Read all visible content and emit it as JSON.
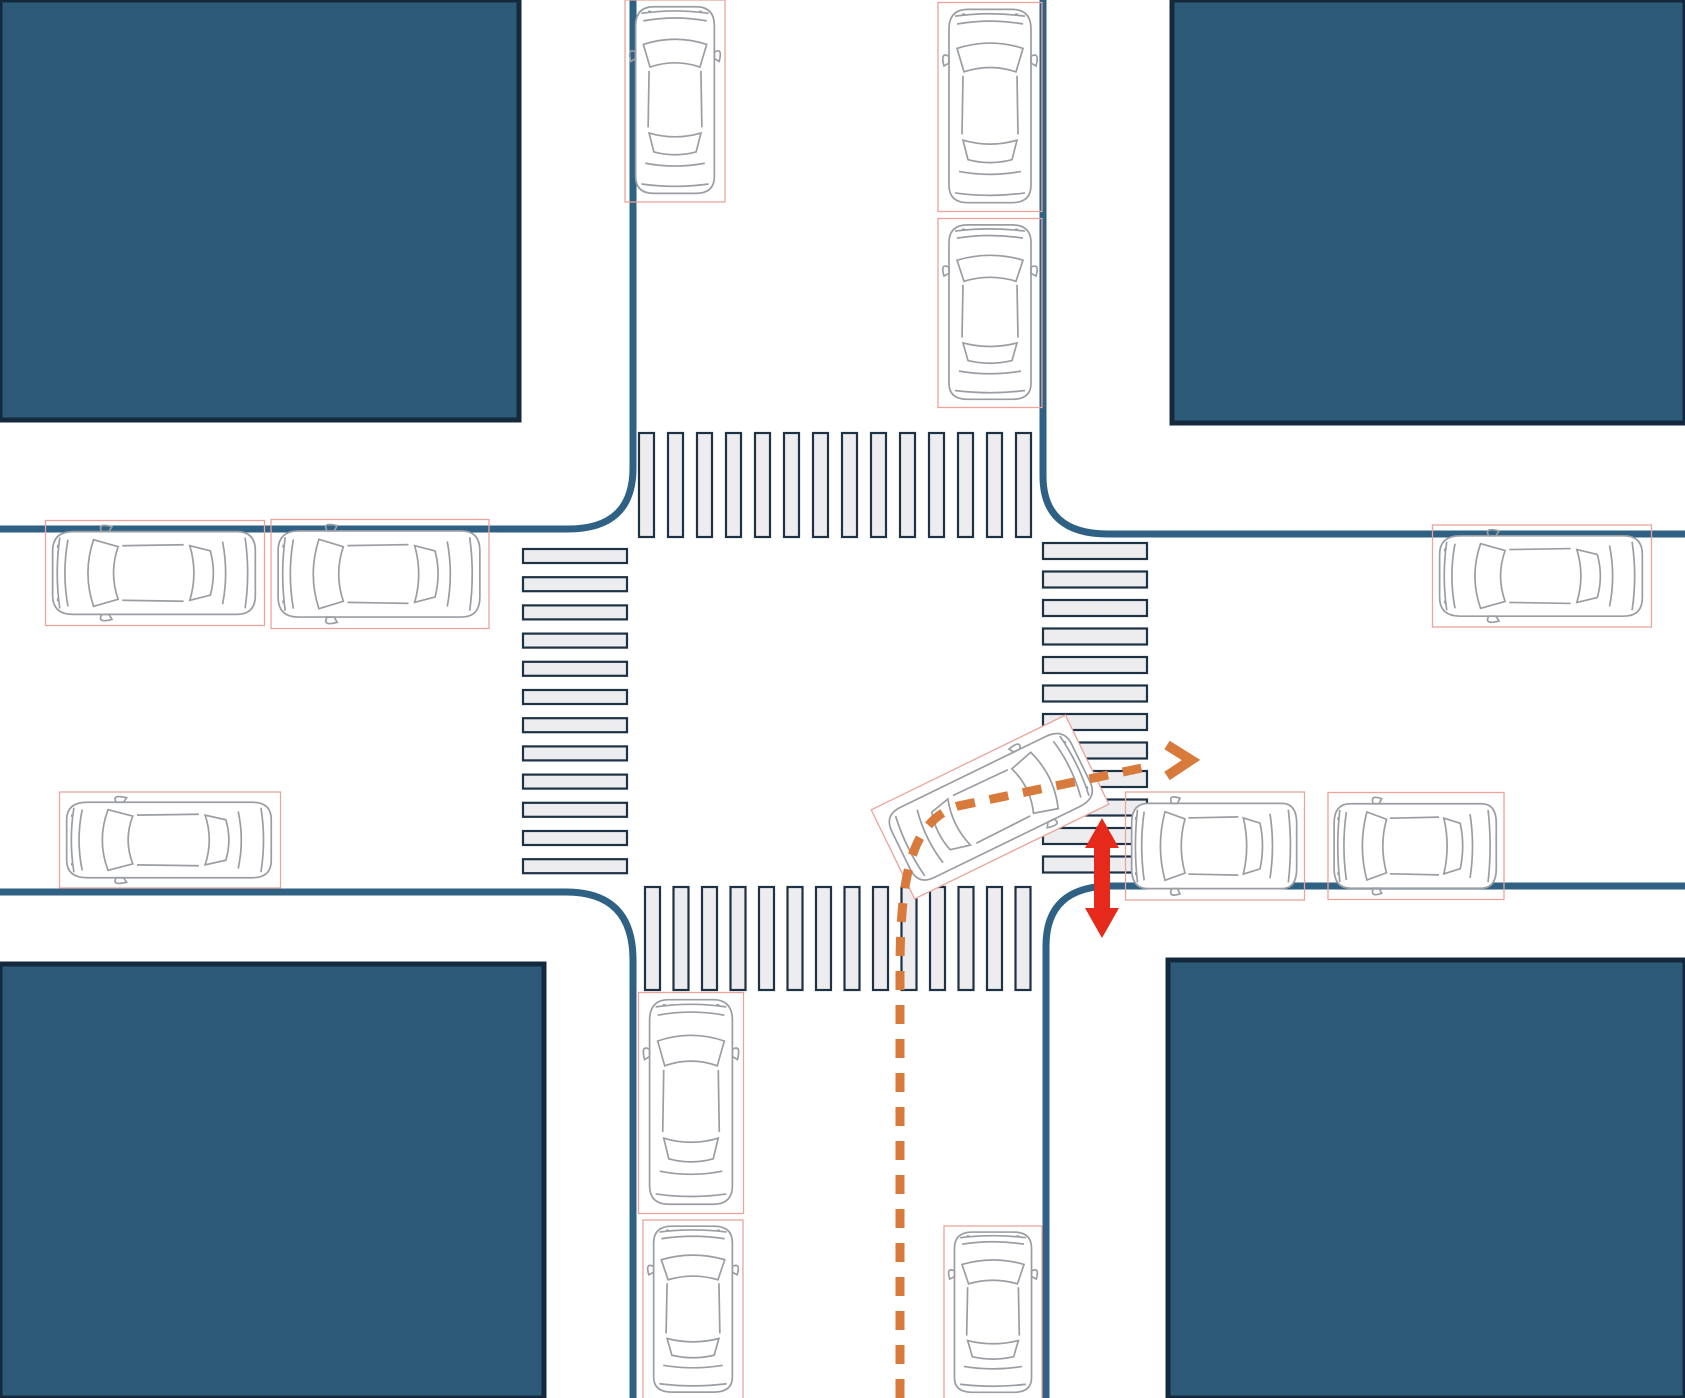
{
  "scene": {
    "name": "four-way-intersection-right-turn-scenario",
    "canvas": {
      "width": 1685,
      "height": 1398,
      "background": "#ffffff"
    },
    "colors": {
      "block_fill": "#2d5b77",
      "block_border": "#142a3c",
      "road_line": "#2e6184",
      "crosswalk_fill": "#ededef",
      "crosswalk_border": "#1d3245",
      "car_line": "#9a9ea3",
      "car_box": "#eba49a",
      "path_orange": "#d87a3c",
      "arrow_red": "#e5291a"
    },
    "blocks": [
      {
        "name": "city-block-northwest",
        "x": 0,
        "y": 0,
        "w": 519,
        "h": 420
      },
      {
        "name": "city-block-northeast",
        "x": 1172,
        "y": 0,
        "w": 513,
        "h": 423
      },
      {
        "name": "city-block-southwest",
        "x": 0,
        "y": 964,
        "w": 544,
        "h": 434
      },
      {
        "name": "city-block-southeast",
        "x": 1168,
        "y": 960,
        "w": 517,
        "h": 438
      }
    ],
    "road_edges": [
      {
        "name": "road-edge-northwest",
        "d": "M 633,0 L 633,468 Q 633,529 568,529 L 0,529"
      },
      {
        "name": "road-edge-northeast",
        "d": "M 1043,0 L 1043,476 Q 1043,534 1108,534 L 1685,534"
      },
      {
        "name": "road-edge-southwest",
        "d": "M 0,892 L 566,892 Q 633,892 633,960 L 633,1398"
      },
      {
        "name": "road-edge-southeast",
        "d": "M 1685,886 L 1112,886 Q 1046,886 1046,946 L 1046,1398"
      }
    ],
    "road_line_width": 7,
    "crosswalks": [
      {
        "name": "crosswalk-north",
        "orientation": "vertical-bars",
        "x": 639,
        "y": 433,
        "count": 14,
        "pitch": 29,
        "bar_w": 15,
        "bar_h": 104
      },
      {
        "name": "crosswalk-south",
        "orientation": "vertical-bars",
        "x": 645,
        "y": 887,
        "count": 14,
        "pitch": 28.5,
        "bar_w": 15,
        "bar_h": 103
      },
      {
        "name": "crosswalk-west",
        "orientation": "horizontal-bars",
        "x": 523,
        "y": 549,
        "count": 12,
        "pitch": 28.2,
        "bar_w": 104,
        "bar_h": 14
      },
      {
        "name": "crosswalk-east",
        "orientation": "horizontal-bars",
        "x": 1043,
        "y": 543,
        "count": 12,
        "pitch": 28.5,
        "bar_w": 104,
        "bar_h": 16
      }
    ],
    "vehicles": [
      {
        "name": "vehicle-north-west-lane",
        "cx": 675,
        "cy": 101,
        "width": 96,
        "length": 198,
        "rotation": 0,
        "highlight": false
      },
      {
        "name": "vehicle-north-east-lane-1",
        "cx": 990,
        "cy": 107,
        "width": 100,
        "length": 205,
        "rotation": 0,
        "highlight": false
      },
      {
        "name": "vehicle-north-east-lane-2",
        "cx": 990,
        "cy": 313,
        "width": 100,
        "length": 185,
        "rotation": 0,
        "highlight": false
      },
      {
        "name": "vehicle-west-north-lane-1",
        "cx": 155,
        "cy": 573,
        "width": 101,
        "length": 215,
        "rotation": 270,
        "highlight": false
      },
      {
        "name": "vehicle-west-north-lane-2",
        "cx": 380,
        "cy": 574,
        "width": 105,
        "length": 214,
        "rotation": 270,
        "highlight": false
      },
      {
        "name": "vehicle-west-south-lane",
        "cx": 170,
        "cy": 840,
        "width": 92,
        "length": 217,
        "rotation": 270,
        "highlight": false
      },
      {
        "name": "vehicle-east-south-lane-1",
        "cx": 1215,
        "cy": 846,
        "width": 104,
        "length": 175,
        "rotation": 270,
        "highlight": false
      },
      {
        "name": "vehicle-east-south-lane-2",
        "cx": 1416,
        "cy": 846,
        "width": 103,
        "length": 172,
        "rotation": 270,
        "highlight": false
      },
      {
        "name": "vehicle-east-north-lane",
        "cx": 1542,
        "cy": 576,
        "width": 98,
        "length": 215,
        "rotation": 270,
        "highlight": false
      },
      {
        "name": "vehicle-south-west-lane-1",
        "cx": 691,
        "cy": 1103,
        "width": 101,
        "length": 217,
        "rotation": 0,
        "highlight": false
      },
      {
        "name": "vehicle-south-west-lane-2",
        "cx": 693,
        "cy": 1310,
        "width": 96,
        "length": 176,
        "rotation": 0,
        "highlight": false
      },
      {
        "name": "vehicle-south-east-lane",
        "cx": 993,
        "cy": 1313,
        "width": 94,
        "length": 170,
        "rotation": 0,
        "highlight": false
      },
      {
        "name": "vehicle-turning-right",
        "cx": 990,
        "cy": 807,
        "width": 95,
        "length": 212,
        "rotation": 64,
        "highlight": true
      }
    ],
    "turn_path": {
      "name": "right-turn-trajectory",
      "d": "M 900,1398 L 900,970 C 900,868 914,820 958,806 L 1142,768",
      "dash": "19 15",
      "stroke_width": 9,
      "arrowhead_d": "M 1167,745 L 1191,760 L 1167,776",
      "arrowhead_width": 10
    },
    "conflict_arrow": {
      "name": "conflict-double-arrow",
      "cx": 1102,
      "top": 818,
      "bottom": 938,
      "shaft_half": 8,
      "head_half": 17,
      "head_len": 30
    }
  }
}
